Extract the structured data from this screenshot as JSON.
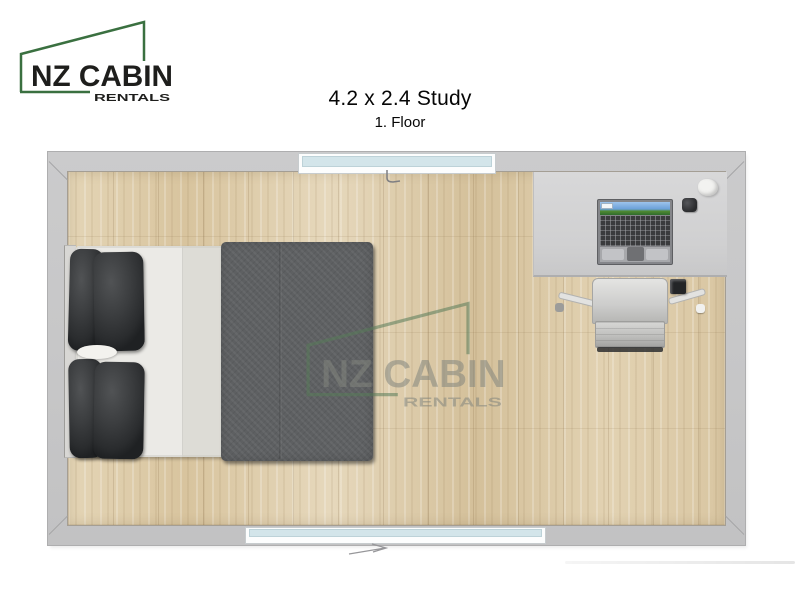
{
  "brand": {
    "name": "NZ CABIN",
    "subtitle": "RENTALS",
    "accent_green": "#3a7040",
    "text_color": "#1e1e1c"
  },
  "header": {
    "title": "4.2 x 2.4 Study",
    "subtitle": "1. Floor"
  },
  "watermark": {
    "name": "NZ CABIN",
    "subtitle": "RENTALS"
  },
  "floorplan": {
    "room_type": "study",
    "colors": {
      "wall": "#c7c7c8",
      "floor_wood": "#ddcba8",
      "desk": "#d3d3d4",
      "duvet": "#5e6062",
      "mattress": "#ebeae6",
      "pillow": "#333537",
      "window_glass": "#d3e5ea",
      "chair": "#c9c9c7"
    },
    "objects": [
      "double-bed",
      "pillows",
      "duvet",
      "desk",
      "laptop",
      "computer-mouse",
      "desk-decor",
      "office-chair",
      "window-top",
      "window-bottom",
      "entry-arrow"
    ]
  }
}
